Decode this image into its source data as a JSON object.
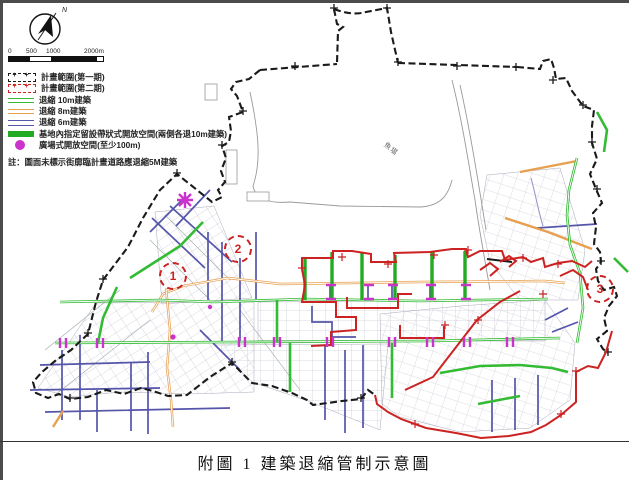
{
  "frame": {
    "caption": "附圖 1 建築退縮管制示意圖"
  },
  "compass": {
    "label": "N"
  },
  "scalebar": {
    "ticks": [
      "0",
      "500",
      "1000",
      "2000m"
    ]
  },
  "legend": {
    "items": [
      {
        "label": "計畫範圍(第一期)"
      },
      {
        "label": "計畫範圍(第二期)"
      },
      {
        "label": "退縮 10m建築"
      },
      {
        "label": "退縮 8m建築"
      },
      {
        "label": "退縮 6m建築"
      },
      {
        "label": "基地內指定留設帶狀式開放空間(兩側各退10m建築)"
      },
      {
        "label": "廣場式開放空間(至少100m)"
      }
    ]
  },
  "note": "註：圖面未標示街廓臨計畫道路應退縮5M建築",
  "map": {
    "water_label": "魚塭",
    "zone_markers": [
      "1",
      "2",
      "3"
    ],
    "colors": {
      "phase1": "#1a1a1a",
      "phase2": "#cc2222",
      "setback10": "#33bb33",
      "setback8": "#e8a050",
      "setback6": "#5555aa",
      "band_open_space": "#22aa22",
      "plaza": "#cc33cc"
    }
  }
}
